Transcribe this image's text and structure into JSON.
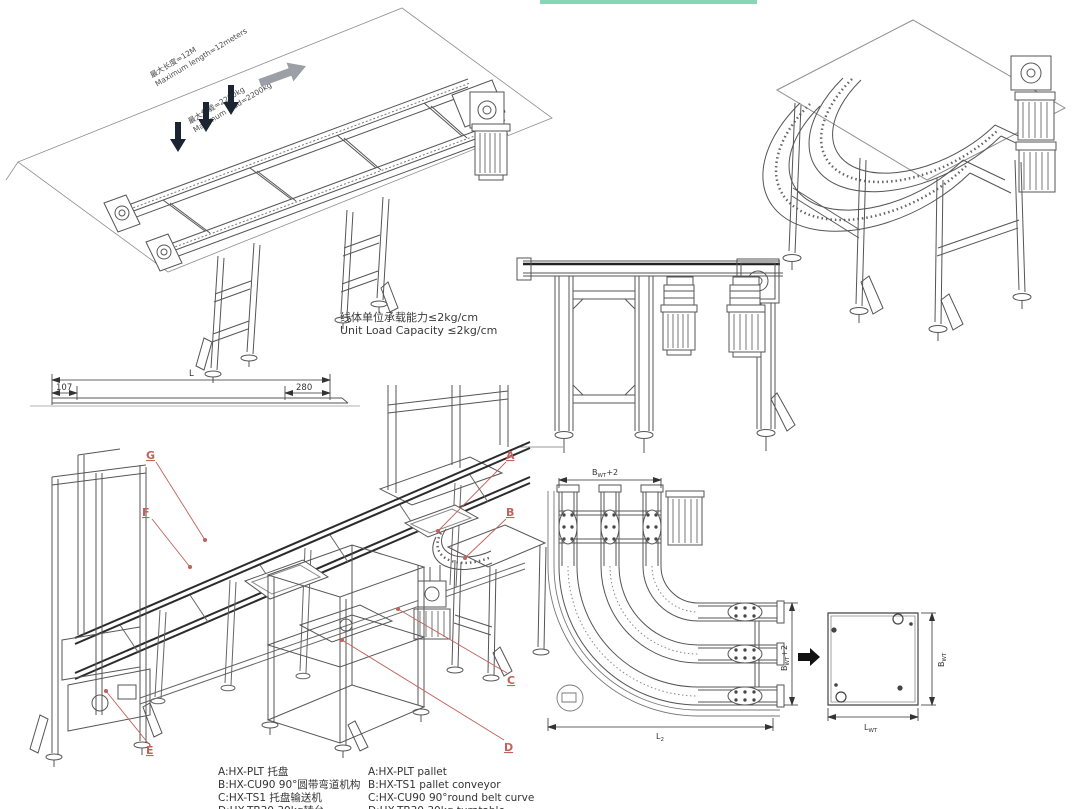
{
  "accent_bar": {
    "color": "#86d6b6"
  },
  "straight_conveyor": {
    "max_length_cn": "最大长度=12M",
    "max_length_en": "Maximum length=12meters",
    "max_load_cn": "最大负载=2200kg",
    "max_load_en": "Maximum load=2200kg",
    "capacity_cn": "线体单位承载能力≤2kg/cm",
    "capacity_en": "Unit Load Capacity ≤2kg/cm"
  },
  "side_dimension_view": {
    "overall": "L",
    "left_offset": "107",
    "right_offset": "280"
  },
  "assembly": {
    "callouts": {
      "a": "A",
      "b": "B",
      "c": "C",
      "d": "D",
      "e": "E",
      "f": "F",
      "g": "G"
    }
  },
  "legend": {
    "cn": [
      "A:HX-PLT 托盘",
      "B:HX-CU90 90°圆带弯道机构",
      "C:HX-TS1 托盘输送机",
      "D:HX-TB30 30kg转台"
    ],
    "en": [
      "A:HX-PLT pallet",
      "B:HX-TS1 pallet conveyor",
      "C:HX-CU90 90°round belt curve",
      "D:HX-TB30 30kg turntable"
    ]
  },
  "plan_view": {
    "dim_top": {
      "base": "B",
      "sub": "WT",
      "suffix": "+2"
    },
    "dim_right": {
      "base": "B",
      "sub": "WT",
      "suffix": "+2"
    },
    "dim_bottom": {
      "base": "L",
      "sub": "2",
      "suffix": ""
    },
    "pallet_length": {
      "base": "L",
      "sub": "WT",
      "suffix": ""
    },
    "pallet_width": {
      "base": "B",
      "sub": "WT",
      "suffix": ""
    }
  },
  "colors": {
    "callout": "#c0635b",
    "line": "#555555",
    "dark_rail": "#2b2b2b"
  }
}
